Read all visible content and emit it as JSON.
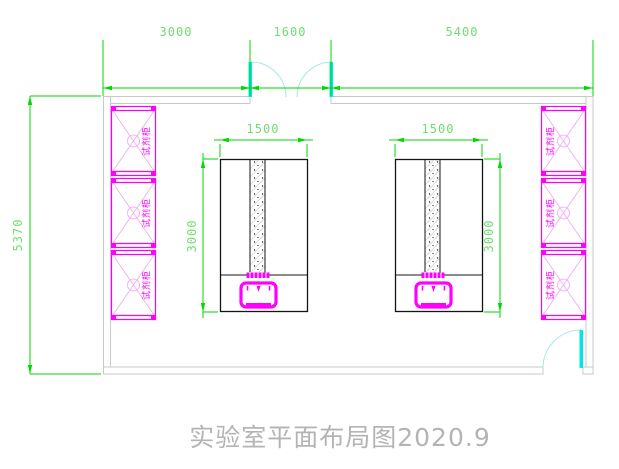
{
  "title": "实验室平面布局图2020.9",
  "dimensions": {
    "top_segments": [
      "3000",
      "1600",
      "5400"
    ],
    "left_height": "5370",
    "bench_width_left": "1500",
    "bench_width_right": "1500",
    "bench_length_left": "3000",
    "bench_length_right": "3000"
  },
  "cabinets": {
    "left": [
      "试剂柜",
      "试剂柜",
      "试剂柜"
    ],
    "right": [
      "试剂柜",
      "试剂柜",
      "试剂柜"
    ]
  },
  "colors": {
    "green": "#00d800",
    "green_text": "#70dd70",
    "wall": "#c9c9c9",
    "magenta": "#ff00ff",
    "magenta_light": "#f0b4f0",
    "cyan": "#00e6e6",
    "cyan_light": "#a8e6e6",
    "ink": "#141414",
    "title_gray": "#b4b4b4",
    "hatch": "#d9d9d9"
  }
}
